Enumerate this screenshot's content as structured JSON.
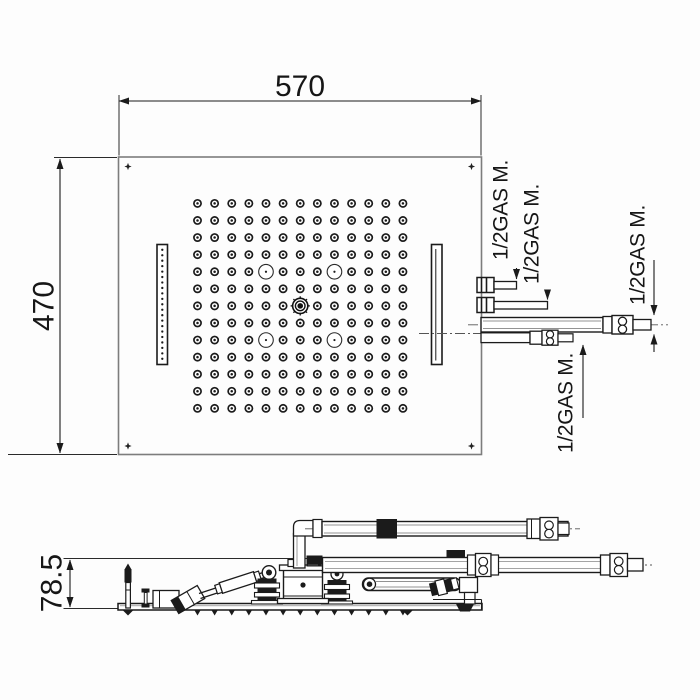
{
  "page": {
    "background": "#fdfdfd"
  },
  "colors": {
    "line": "#1b1b1b",
    "panel_stroke": "#7d7d7d",
    "centerline": "#555555",
    "text": "#161616"
  },
  "dimensions": {
    "width": "570",
    "height": "470",
    "side_height": "78.5"
  },
  "labels": {
    "gas": [
      "1/2GAS M.",
      "1/2GAS M.",
      "1/2GAS M.",
      "1/2GAS M."
    ]
  },
  "top_view": {
    "grid": {
      "cols": 13,
      "rows": 13,
      "regular_nozzle_count": 164,
      "led_spot_count": 4,
      "led_positions": [
        [
          4,
          4
        ],
        [
          4,
          8
        ],
        [
          8,
          4
        ],
        [
          8,
          8
        ]
      ],
      "center_position": [
        6,
        6
      ],
      "central_nozzle_count": 1
    },
    "left_slot_jet_count": 21,
    "corner_screw_count": 4,
    "side_slot_count": 2
  }
}
